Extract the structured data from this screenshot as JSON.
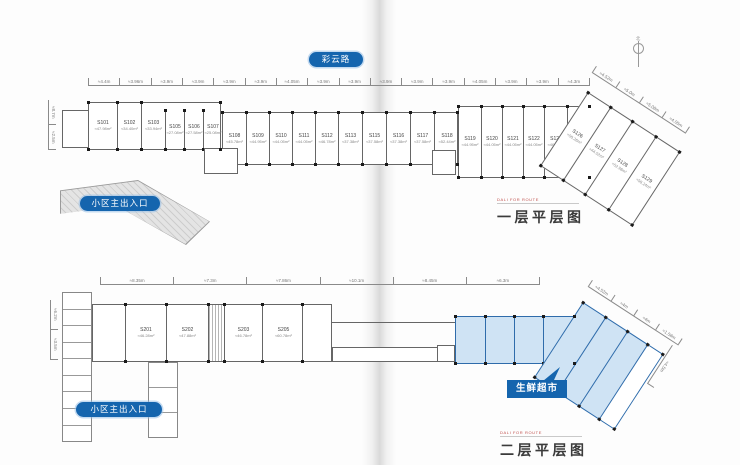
{
  "spread": {
    "road_badge": "彩云路",
    "north_label": "北"
  },
  "colors": {
    "badge_blue": "#1565ae",
    "highlight_fill": "#cfe3f4",
    "highlight_stroke": "#2f6cab",
    "accent_red": "#c0504d"
  },
  "plan1": {
    "subtitle": "DALI FOR ROUTE",
    "title": "一层平层图",
    "entrance_badge": "小区主出入口",
    "dims_top": [
      "≈4.4m",
      "≈3.96m",
      "≈3.9m",
      "≈3.9m",
      "≈3.9m",
      "≈3.9m",
      "≈4.05m",
      "≈3.9m",
      "≈3.9m",
      "≈3.9m",
      "≈3.9m",
      "≈3.9m",
      "≈4.05m",
      "≈3.9m",
      "≈3.9m",
      "≈4.3m"
    ],
    "dims_angled": [
      "≈4.52m",
      "≈5.0m",
      "≈5.08m",
      "≈4.05m"
    ],
    "dims_left": [
      "≈8.7m",
      "≈2.5m"
    ],
    "block1": [
      {
        "id": "S101",
        "area": "≈47.98m²",
        "w": 28
      },
      {
        "id": "S102",
        "area": "≈34.40m²",
        "w": 24
      },
      {
        "id": "S103",
        "area": "≈33.94m²",
        "w": 24
      },
      {
        "id": "S105",
        "area": "≈27.08m²",
        "w": 19,
        "dy": 8
      },
      {
        "id": "S106",
        "area": "≈27.58m²",
        "w": 19,
        "dy": 8
      },
      {
        "id": "S107",
        "area": "≈25.08m²",
        "w": 19,
        "dy": 8
      }
    ],
    "block2": [
      {
        "id": "S108",
        "area": "≈45.78m²",
        "w": 23
      },
      {
        "id": "S109",
        "area": "≈44.95m²",
        "w": 23
      },
      {
        "id": "S110",
        "area": "≈44.05m²",
        "w": 23
      },
      {
        "id": "S111",
        "area": "≈44.05m²",
        "w": 23
      },
      {
        "id": "S112",
        "area": "≈46.78m²",
        "w": 23
      },
      {
        "id": "S113",
        "area": "≈37.38m²",
        "w": 24
      },
      {
        "id": "S115",
        "area": "≈37.58m²",
        "w": 24
      },
      {
        "id": "S116",
        "area": "≈37.38m²",
        "w": 24
      },
      {
        "id": "S117",
        "area": "≈37.58m²",
        "w": 24
      },
      {
        "id": "S118",
        "area": "≈52.44m²",
        "w": 25
      }
    ],
    "block3": [
      {
        "id": "S119",
        "area": "≈44.95m²",
        "w": 22
      },
      {
        "id": "S120",
        "area": "≈44.05m²",
        "w": 21
      },
      {
        "id": "S121",
        "area": "≈44.05m²",
        "w": 21
      },
      {
        "id": "S122",
        "area": "≈44.05m²",
        "w": 21
      },
      {
        "id": "S123",
        "area": "≈46.78m²",
        "w": 23
      },
      {
        "id": "S125",
        "area": "≈47.38m²",
        "w": 24
      }
    ],
    "block_angled": [
      {
        "id": "S126",
        "area": "≈50.26m²",
        "w": 26
      },
      {
        "id": "S127",
        "area": "≈44.52m²",
        "w": 26
      },
      {
        "id": "S128",
        "area": "≈52.98m²",
        "w": 28
      },
      {
        "id": "S129",
        "area": "≈58.24m²",
        "w": 30
      }
    ]
  },
  "plan2": {
    "subtitle": "DALI FOR ROUTE",
    "title": "二层平层图",
    "entrance_badge": "小区主出入口",
    "supermarket_badge": "生鲜超市",
    "dims_top": [
      "≈8.35m",
      "≈7.3m",
      "≈7.86m",
      "≈10.1m",
      "≈8.45m",
      "≈6.3m"
    ],
    "dims_angled": [
      "≈4.52m",
      "≈4m",
      "≈4m",
      "≈1.58m"
    ],
    "dims_left": [
      "≈6.2m",
      "≈3.5m"
    ],
    "dim_right_v": "≈4.5m",
    "units": [
      {
        "id": "S201",
        "area": "≈46.28m²",
        "w": 40
      },
      {
        "id": "S202",
        "area": "≈47.88m²",
        "w": 42
      },
      {
        "id": "",
        "area": "",
        "w": 16,
        "stair": true
      },
      {
        "id": "S203",
        "area": "≈46.78m²",
        "w": 38
      },
      {
        "id": "S205",
        "area": "≈60.78m²",
        "w": 42
      }
    ],
    "blue_bays": [
      {
        "id": "",
        "area": "",
        "w": 29
      },
      {
        "id": "",
        "area": "",
        "w": 29
      },
      {
        "id": "",
        "area": "",
        "w": 29
      },
      {
        "id": "",
        "area": "",
        "w": 31
      }
    ],
    "blue_bays_angled": [
      {
        "id": "",
        "area": "",
        "w": 26
      },
      {
        "id": "",
        "area": "",
        "w": 26
      },
      {
        "id": "",
        "area": "",
        "w": 24
      },
      {
        "id": "",
        "area": "",
        "w": 18,
        "white": true
      }
    ],
    "left_cells": 9,
    "left_cells2": 3
  }
}
